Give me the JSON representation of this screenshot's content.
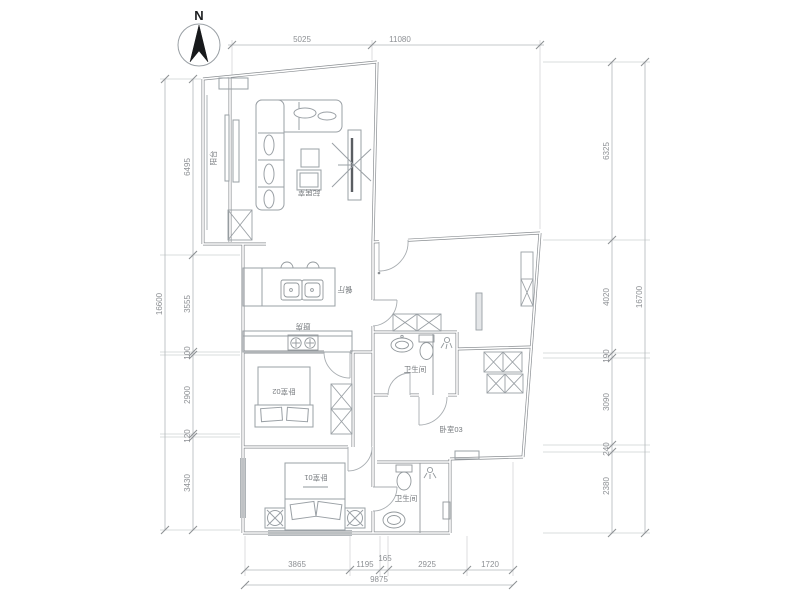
{
  "meta": {
    "background_color": "#ffffff",
    "wall_color": "#8a8e92",
    "furniture_color": "#9aa0a5",
    "dimension_text_color": "#8d9094",
    "room_text_color": "#75797d"
  },
  "compass": {
    "label": "N"
  },
  "rooms": {
    "balcony": "阳台",
    "living": "起居室",
    "dining": "餐厅",
    "kitchen": "厨房",
    "bedroom1": "卧室01",
    "bedroom2": "卧室02",
    "bedroom3": "卧室03",
    "bathroom_master": "卫生间",
    "bathroom_guest": "卫生间"
  },
  "dimensions": {
    "top": {
      "segments": [
        "5025",
        "11080"
      ]
    },
    "left": {
      "segments": [
        "6495",
        "3555",
        "100",
        "2900",
        "120",
        "3430"
      ],
      "total": "16600"
    },
    "right": {
      "segments": [
        "6325",
        "4020",
        "190",
        "3090",
        "240",
        "2380"
      ],
      "total": "16700"
    },
    "bottom": {
      "segments": [
        "3865",
        "1195",
        "165",
        "2925",
        "1720"
      ],
      "total": "9875"
    }
  }
}
